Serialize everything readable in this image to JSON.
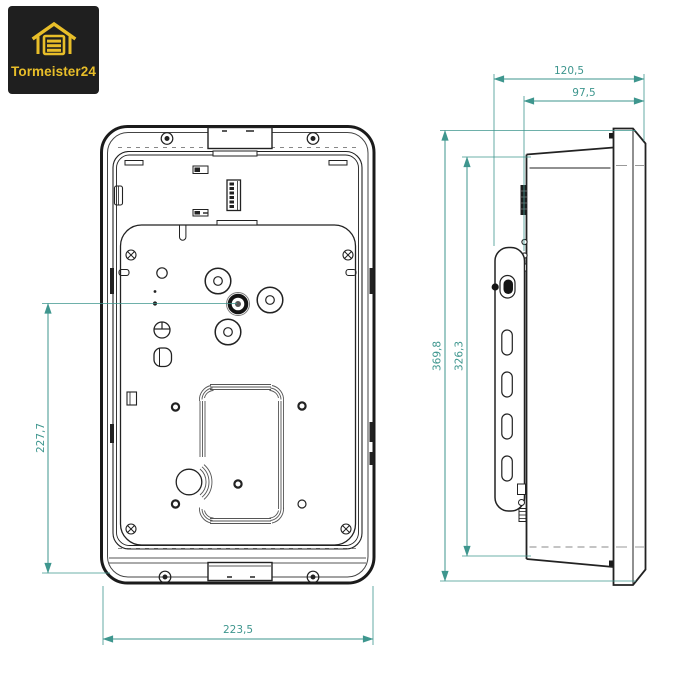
{
  "brand": {
    "name": "Tormeister24"
  },
  "colors": {
    "logo_background": "#1F1F1F",
    "logo_yellow": "#E8BE29",
    "drawing_line": "#222222",
    "dimension_teal": "#3E968E"
  },
  "drawing": {
    "dimensions": {
      "depth_total": "120,5",
      "depth_housing": "97,5",
      "height_total": "369,8",
      "height_housing": "326,3",
      "height_center": "227,7",
      "width_front": "223,5"
    }
  }
}
